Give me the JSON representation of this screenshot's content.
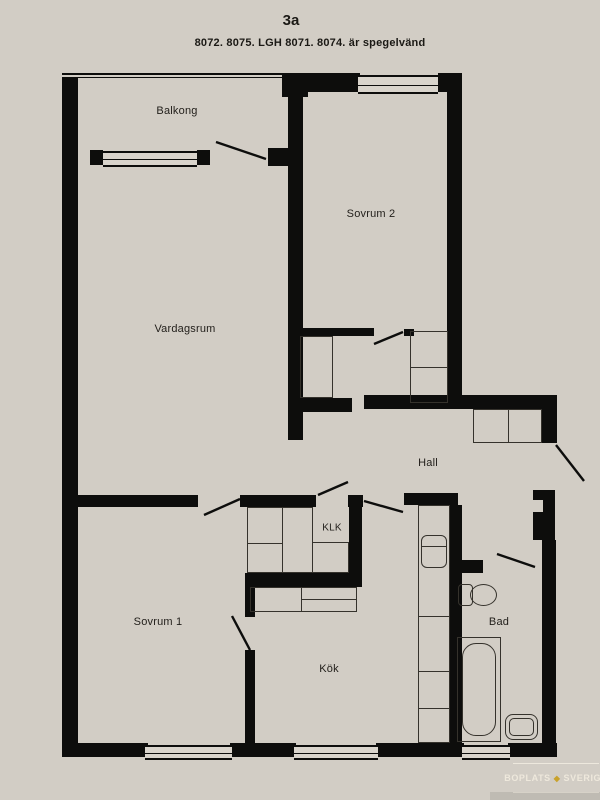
{
  "header": {
    "title": "3a",
    "subtitle": "8072. 8075. LGH 8071. 8074. är spegelvänd"
  },
  "rooms": {
    "balcony": {
      "label": "Balkong"
    },
    "bedroom2": {
      "label": "Sovrum 2"
    },
    "livingroom": {
      "label": "Vardagsrum"
    },
    "hall": {
      "label": "Hall"
    },
    "closet": {
      "label": "KLK"
    },
    "bedroom1": {
      "label": "Sovrum 1"
    },
    "kitchen": {
      "label": "Kök"
    },
    "bathroom": {
      "label": "Bad"
    }
  },
  "watermark": {
    "brand_left": "BOPLATS",
    "separator_icon": "diamond-icon",
    "separator_glyph": "◆",
    "brand_right": "SVERIGE"
  },
  "colors": {
    "background": "#d2cdc5",
    "wall": "#0d0d0c",
    "text": "#211e1a",
    "watermark_text": "#f8f2e5",
    "watermark_gold": "#c9a22b"
  }
}
